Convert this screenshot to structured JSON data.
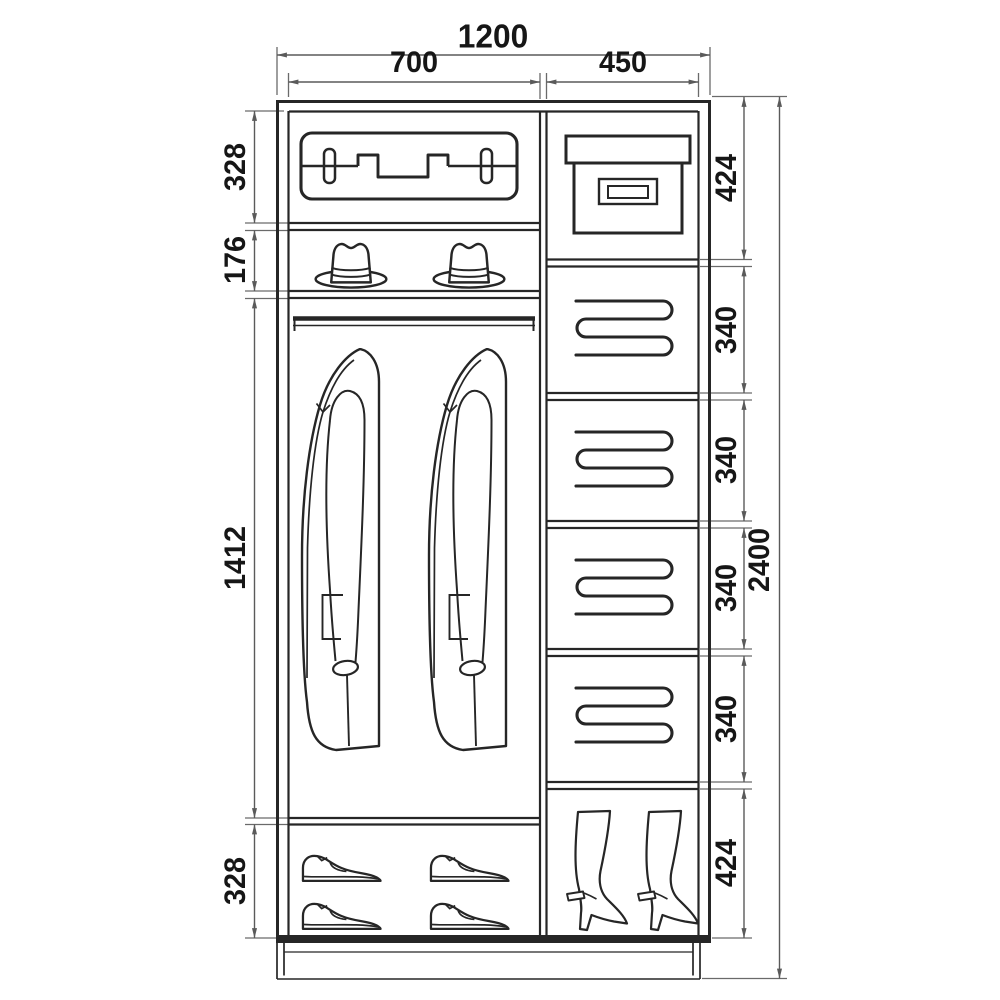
{
  "drawing": {
    "subject": "two-section wardrobe interior elevation",
    "units": "mm",
    "colors": {
      "background": "#ffffff",
      "furniture_line": "#262626",
      "dimension_line": "#5a5a5a",
      "text": "#161616"
    }
  },
  "dims": {
    "overall_width": "1200",
    "left_width": "700",
    "right_width": "450",
    "overall_height": "2400",
    "left_chain": [
      "328",
      "176",
      "1412",
      "328"
    ],
    "right_chain": [
      "424",
      "340",
      "340",
      "340",
      "340",
      "424"
    ]
  },
  "icons": {
    "left_section": [
      "suitcase",
      "hat",
      "hat",
      "coat",
      "coat",
      "shoe",
      "shoe",
      "shoe",
      "shoe"
    ],
    "right_section": [
      "storage-box",
      "folded-linen",
      "folded-linen",
      "folded-linen",
      "folded-linen",
      "boot",
      "boot"
    ]
  }
}
